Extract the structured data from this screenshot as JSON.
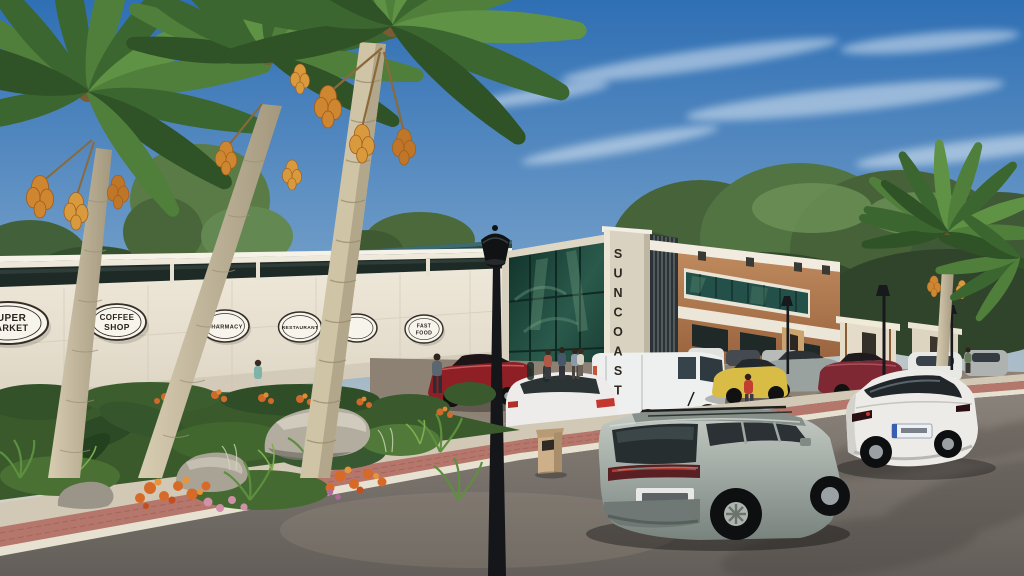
{
  "scene": {
    "type": "architectural-rendering",
    "name": "Suncoast retail plaza street view",
    "tower_sign": "SUNCOAST",
    "shop_signs": [
      {
        "line1": "SUPER",
        "line2": "MARKET"
      },
      {
        "line1": "COFFEE",
        "line2": "SHOP"
      },
      {
        "line1": "PHARMACY",
        "line2": ""
      },
      {
        "line1": "RESTAURANT",
        "line2": ""
      },
      {
        "line1": "FAST",
        "line2": "FOOD"
      }
    ]
  },
  "palette": {
    "sky_top": "#3470b5",
    "sky_horizon": "#e3dccb",
    "foliage_green": "#4c6a3e",
    "wall_cream": "#ece6d8",
    "terracotta": "#b5825a",
    "glass_green": "#234f43",
    "asphalt": "#6f6964",
    "brick_path": "#b5766b",
    "suv_silver": "#9fa8a2",
    "tesla_white": "#ecebe7",
    "red_car": "#8e2025",
    "yellow_car": "#d8bc45",
    "date_orange": "#d08a33"
  }
}
